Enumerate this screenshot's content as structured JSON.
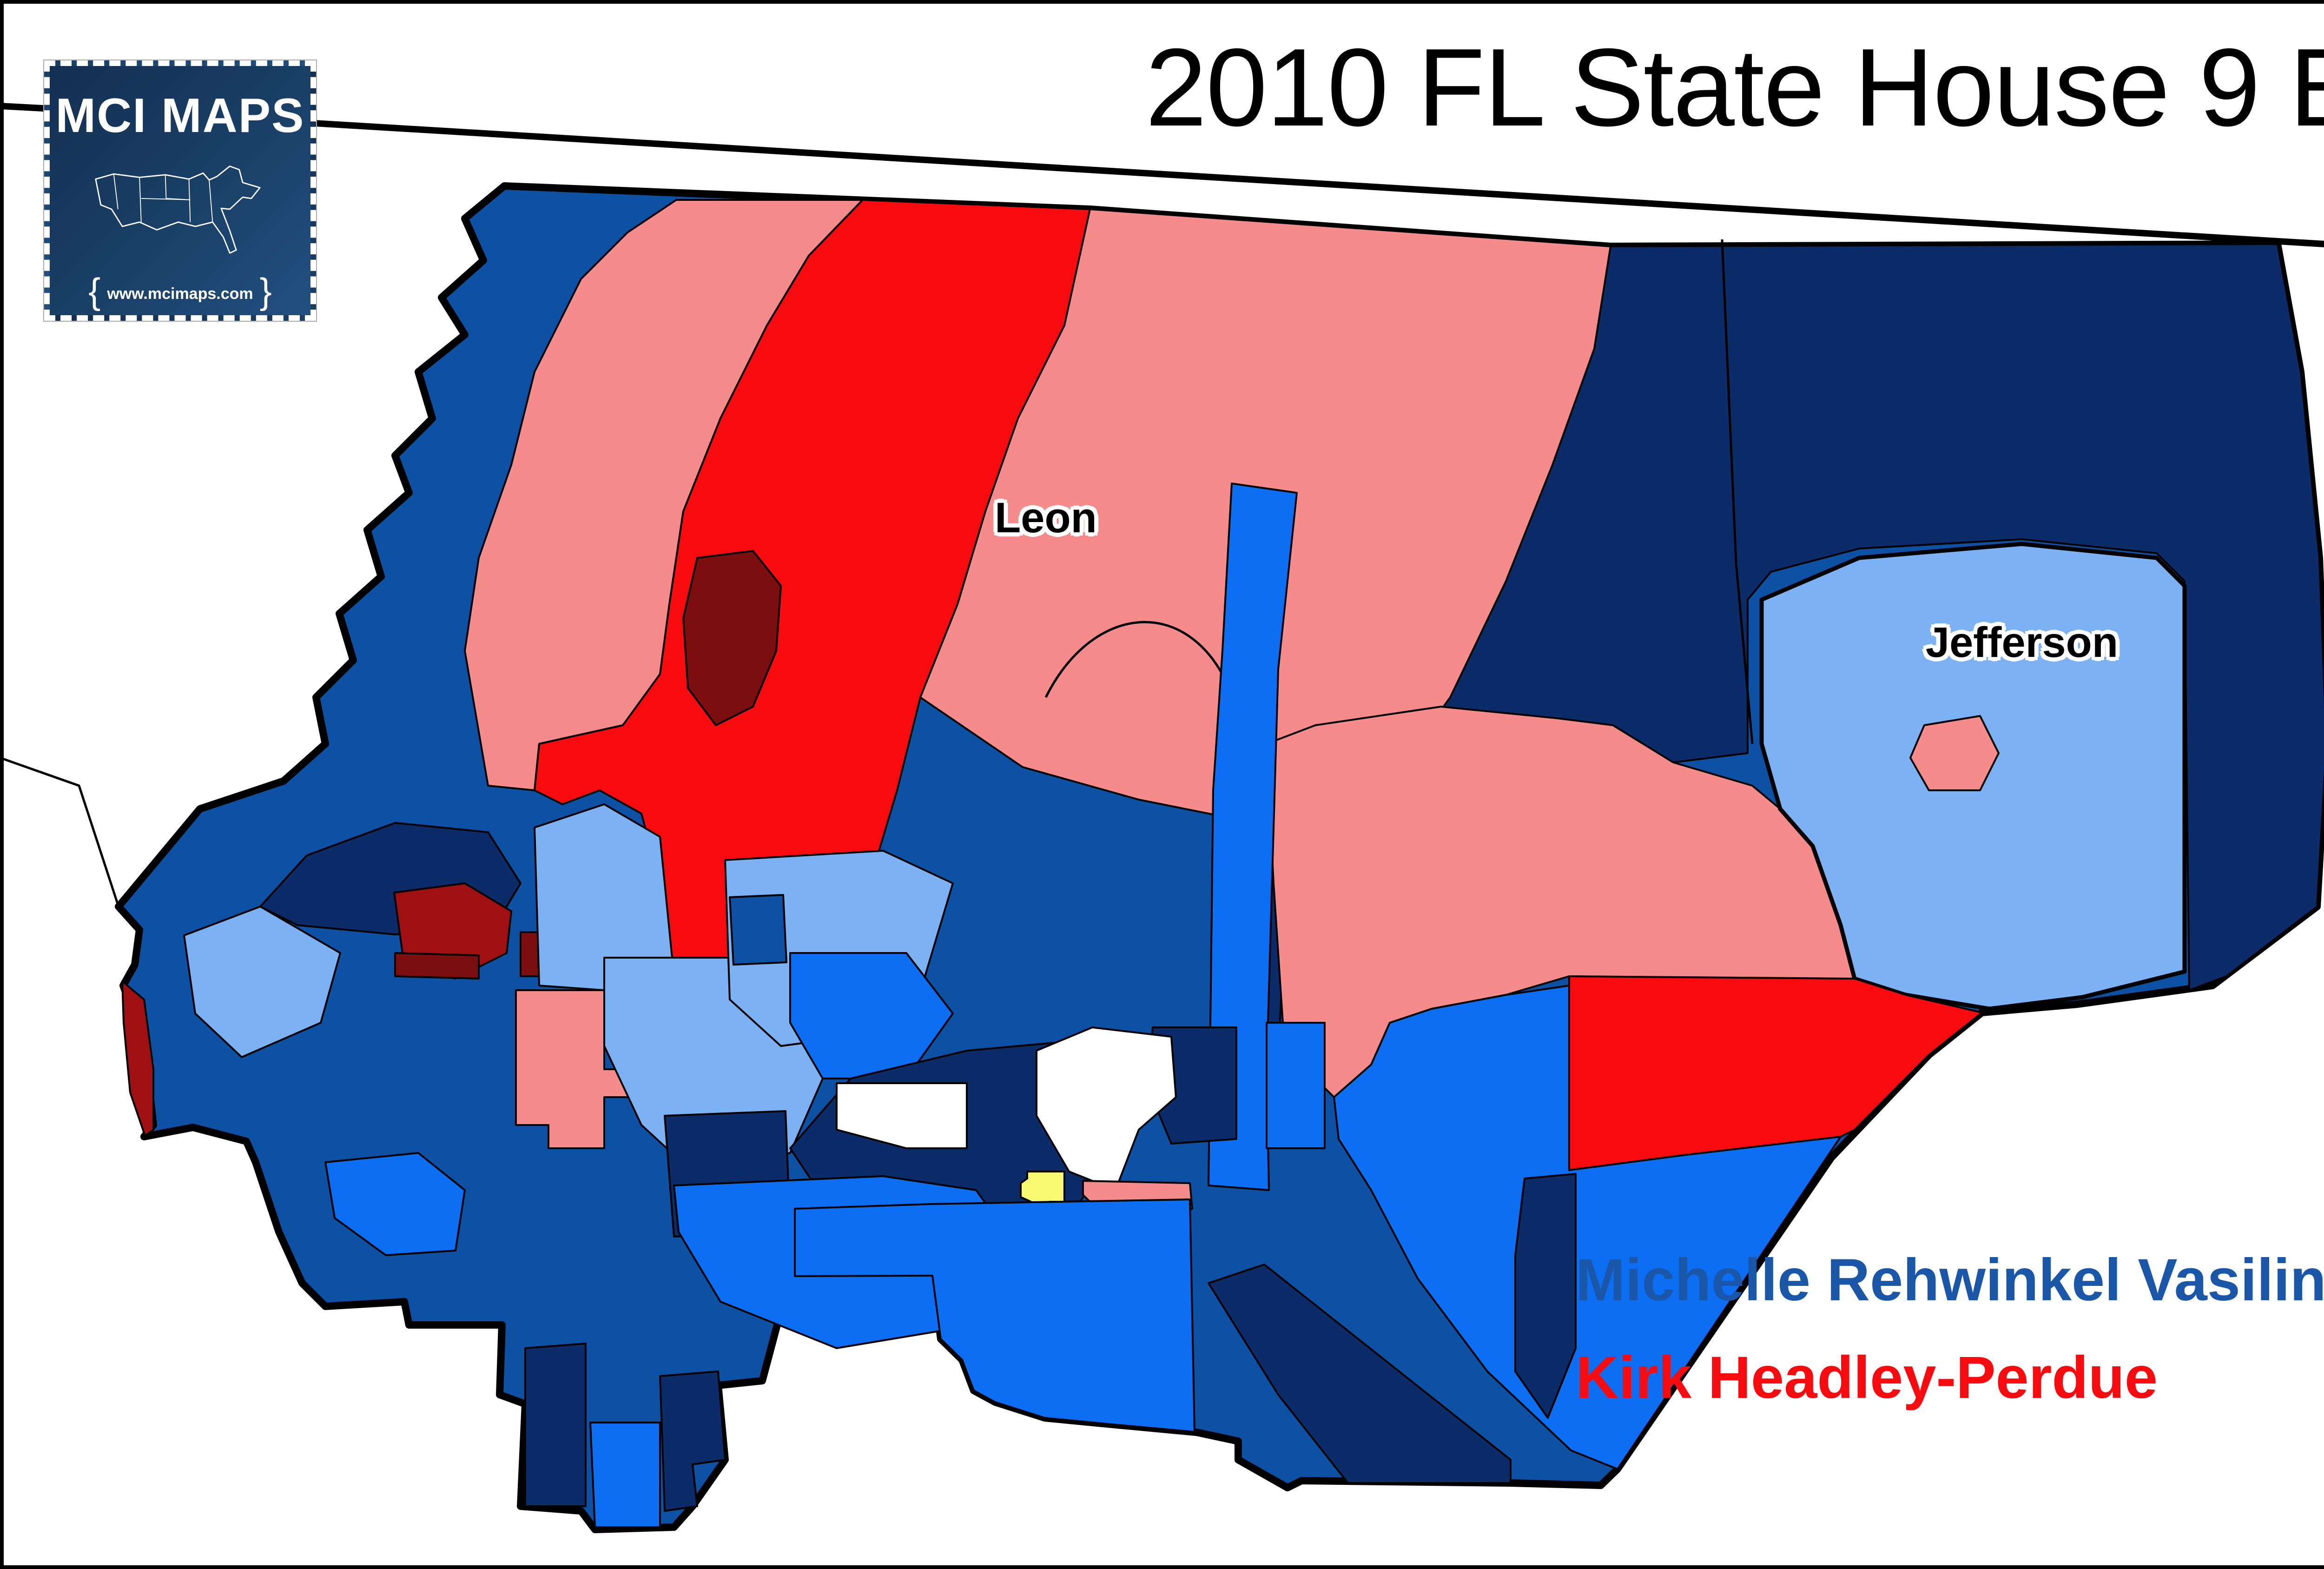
{
  "title": "2010 FL State House 9 Election",
  "logo": {
    "name": "MCI MAPS",
    "url": "www.mcimaps.com",
    "brace_left": "{",
    "brace_right": "}"
  },
  "map": {
    "county_labels": [
      {
        "text": "Leon"
      },
      {
        "text": "Jefferson"
      }
    ]
  },
  "legend": {
    "header": "Vasilinda  %",
    "items": [
      {
        "label": "0% - 30%",
        "color": "#7D0E10"
      },
      {
        "label": "30.01% - 40%",
        "color": "#A01013"
      },
      {
        "label": "40.01% - 45%",
        "color": "#F90A0E"
      },
      {
        "label": "45.01% - 49%",
        "color": "#F68B8B"
      },
      {
        "label": "Tie",
        "color": "#F9F871"
      },
      {
        "label": "50.02% - 55%",
        "color": "#7CB1F4"
      },
      {
        "label": "55.01% - 60%",
        "color": "#0B6EF3"
      },
      {
        "label": "60.01% - 70%",
        "color": "#0C51A4"
      },
      {
        "label": "70.01% - 93%",
        "color": "#0C2C69"
      }
    ]
  },
  "results": [
    {
      "candidate": "Michelle Rehwinkel Vasilinda",
      "percent": "58.7%",
      "color": "#1A57A8"
    },
    {
      "candidate": "Kirk Headley-Perdue",
      "percent": "41.3%",
      "color": "#F90A0E"
    }
  ],
  "palette": {
    "cat_0_30": "#7D0E10",
    "cat_30_40": "#A01013",
    "cat_40_45": "#F90A0E",
    "cat_45_49": "#F68B8B",
    "tie": "#F9F871",
    "cat_50_55": "#7CB1F4",
    "cat_55_60": "#0B6EF3",
    "cat_60_70": "#0C51A4",
    "cat_70_93": "#0C2C69",
    "no_data": "#FFFFFF",
    "line": "#000000"
  }
}
